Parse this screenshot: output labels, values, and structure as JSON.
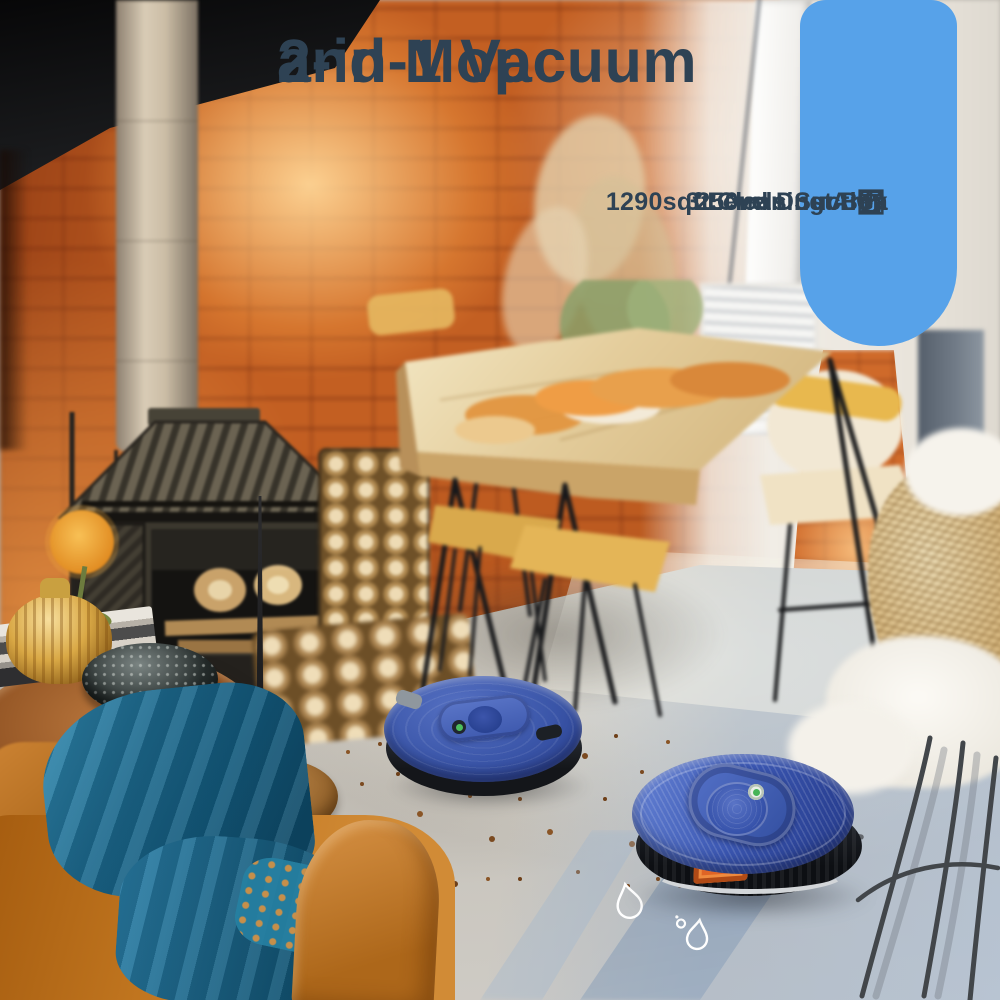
{
  "headline": {
    "line1": "2-in-1 Vacuum",
    "line2": "and Mop"
  },
  "features": [
    {
      "label": "250ml Dust Box",
      "icon": "dust-box-icon"
    },
    {
      "label": "3 Levels Suction",
      "icon": "suction-levels-icon"
    },
    {
      "label": "1290sqft Cleaning Area",
      "icon": "cleaning-area-icon"
    }
  ],
  "colors": {
    "capsule_accent": "#57a2e9",
    "headline_text": "#2e4254",
    "robot_body_blue": "#3b57b2",
    "water_trail_blue": "#8aa4c2",
    "brick_orange": "#c35f22"
  },
  "floor_markers": [
    {
      "icon": "water-droplet-outline-large"
    },
    {
      "icon": "water-droplet-outline-small"
    }
  ]
}
